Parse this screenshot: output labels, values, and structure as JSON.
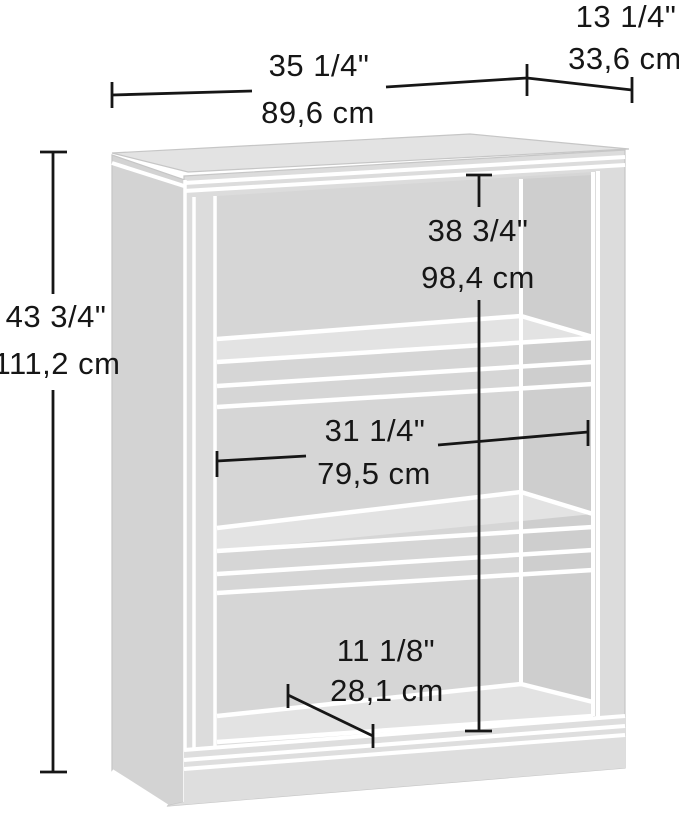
{
  "figure": {
    "type": "furniture-dimension-diagram",
    "subject": "3-shelf bookcase line drawing in perspective",
    "colors": {
      "background": "#ffffff",
      "panel_gray": "#d7d7d7",
      "panel_light": "#e4e4e4",
      "separator_line": "#ffffff",
      "dimension_line": "#161616"
    },
    "dimensions": {
      "width": {
        "in": "35 1/4\"",
        "cm": "89,6 cm"
      },
      "depth": {
        "in": "13 1/4\"",
        "cm": "33,6 cm"
      },
      "height": {
        "in": "43 3/4\"",
        "cm": "111,2 cm"
      },
      "interior_height": {
        "in": "38 3/4\"",
        "cm": "98,4 cm"
      },
      "interior_width": {
        "in": "31 1/4\"",
        "cm": "79,5 cm"
      },
      "shelf_depth": {
        "in": "11 1/8\"",
        "cm": "28,1 cm"
      }
    }
  }
}
